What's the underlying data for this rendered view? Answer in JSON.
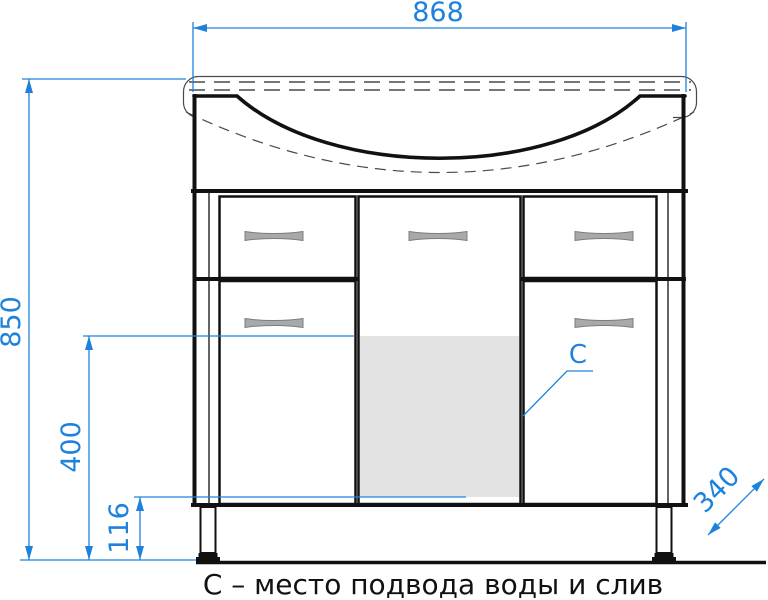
{
  "dimensions": {
    "total_width": "868",
    "total_height": "850",
    "inlet_height": "400",
    "leg_height": "116",
    "depth": "340"
  },
  "labels": {
    "connection_marker": "C"
  },
  "caption": "С – место подвода воды и слив",
  "colors": {
    "dimension_blue": "#1E82DC",
    "outline_black": "#111111",
    "shaded_zone_gray": "#E3E3E3",
    "handle_gray": "#A9A9A9",
    "background": "#FFFFFF"
  }
}
